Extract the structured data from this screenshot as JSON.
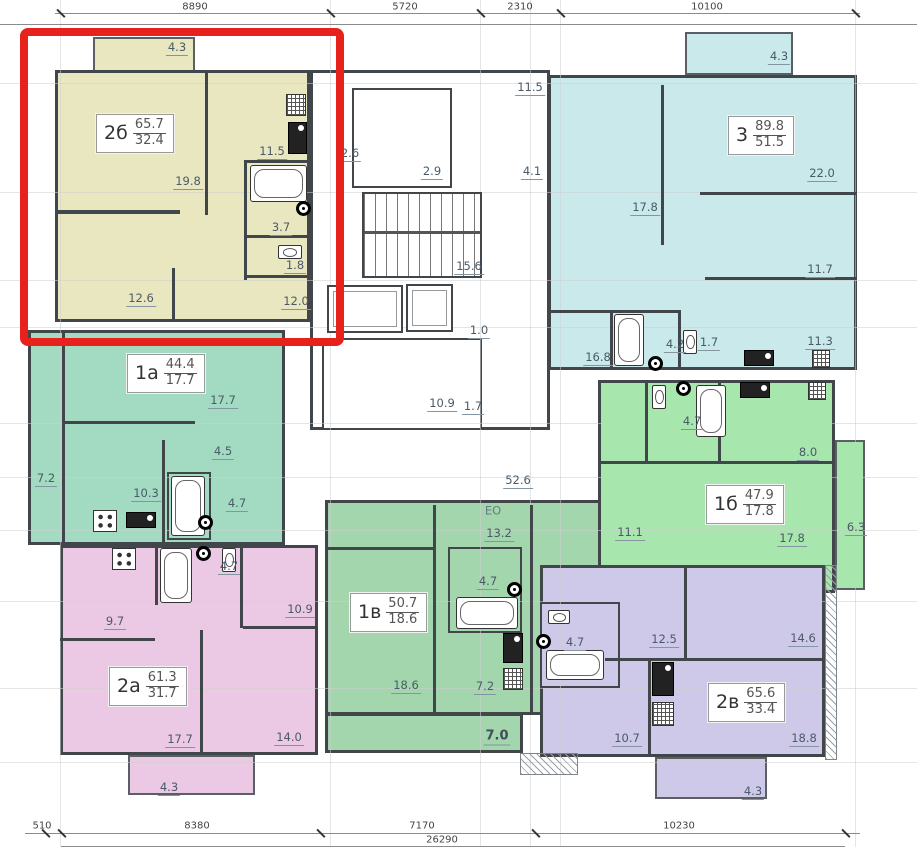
{
  "dim_top": {
    "t1": "8890",
    "t2": "5720",
    "t3": "2310",
    "t4": "10100"
  },
  "dim_bottom": {
    "b1": "510",
    "b2": "8380",
    "b3": "7170",
    "b4": "10230",
    "total": "26290"
  },
  "apartments": {
    "a2b": {
      "label": "2б",
      "total": "65.7",
      "living": "32.4",
      "rooms": {
        "living": "19.8",
        "kitchen": "11.5",
        "bath": "3.7",
        "wc": "1.8",
        "bed1": "12.6",
        "bed2": "12.0",
        "balcony": "4.3"
      }
    },
    "a3": {
      "label": "3",
      "total": "89.8",
      "living": "51.5",
      "rooms": {
        "bed1": "17.8",
        "living": "22.0",
        "bed2": "11.7",
        "bed3": "11.3",
        "kitchen": "16.8",
        "bath": "4.2",
        "wc": "1.7",
        "balcony": "4.3"
      }
    },
    "a1a": {
      "label": "1а",
      "total": "44.4",
      "living": "17.7",
      "rooms": {
        "living": "17.7",
        "hall": "4.5",
        "kitchen": "10.3",
        "bath": "4.7",
        "loggia": "7.2"
      }
    },
    "a1b": {
      "label": "1б",
      "total": "47.9",
      "living": "17.8",
      "rooms": {
        "bath": "4.7",
        "kitchen": "8.0",
        "hall": "11.1",
        "living": "17.8",
        "balcony": "6.3"
      }
    },
    "a2a": {
      "label": "2а",
      "total": "61.3",
      "living": "31.7",
      "rooms": {
        "kitchen": "9.7",
        "bed": "10.9",
        "bath": "4.7",
        "living": "17.7",
        "bed2": "14.0",
        "balcony": "4.3"
      }
    },
    "a1v": {
      "label": "1в",
      "total": "50.7",
      "living": "18.6",
      "rooms": {
        "kitchen": "13.2",
        "bath": "4.7",
        "living": "18.6",
        "hall": "7.2",
        "corridor": "7.0"
      }
    },
    "a2v": {
      "label": "2в",
      "total": "65.6",
      "living": "33.4",
      "rooms": {
        "bed1": "12.5",
        "bed2": "14.6",
        "bath": "4.7",
        "hall": "10.7",
        "living": "18.8",
        "balcony": "4.3"
      }
    }
  },
  "core": {
    "c26": "2.6",
    "c29": "2.9",
    "c41": "4.1",
    "c115": "11.5",
    "c156": "15.6",
    "c10": "1.0",
    "c109": "10.9",
    "c17": "1.7"
  },
  "misc": {
    "floor_area": "52.6",
    "eo": "ЕО"
  },
  "colors": {
    "highlight": "#e7221c",
    "wall": "#41464b",
    "a2b": "#e9e7bf",
    "a3": "#c9e9ea",
    "a1a": "#a2dbc1",
    "a1b": "#a7e6ad",
    "a2a": "#ebc8e3",
    "a1v": "#a3d6ad",
    "a2v": "#cfc9e9"
  }
}
